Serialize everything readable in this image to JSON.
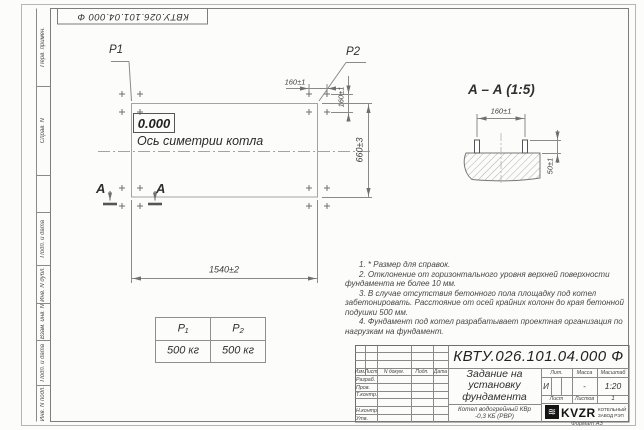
{
  "colors": {
    "paper": "#fcfcfb",
    "line": "#8a8a8a",
    "ink": "#2f2f2f"
  },
  "top_stamp": {
    "code": "КВТУ.026.101.04.000 Ф"
  },
  "margin_fields": {
    "labels": [
      "Перв. примен.",
      "Справ. N",
      "Подп. и дата",
      "Инв. N дубл.",
      "Взам. инв. N",
      "Подп. и дата",
      "Инв. N подл."
    ]
  },
  "plan": {
    "level_mark": "0.000",
    "axis_label": "Ось симетрии котла",
    "p1": "P1",
    "p2": "P2",
    "dim_width": "1540±2",
    "dim_height": "660±3",
    "dim_bolt_x": "160±1",
    "dim_bolt_y": "160±1",
    "section_letter": "А"
  },
  "section": {
    "title": "А – А (1:5)",
    "dim_spacing": "160±1",
    "dim_protrusion": "50±1"
  },
  "loads_table": {
    "headers": [
      "P₁",
      "P₂"
    ],
    "values": [
      "500 кг",
      "500 кг"
    ]
  },
  "notes": [
    "1. * Размер для справок.",
    "2. Отклонение от горизонтального уровня верхней поверхности фундамента не более 10 мм.",
    "3. В случае отсутствия бетонного пола площадку под котел забетонировать. Расстояние от осей крайних колонн до края бетонной подушки 500 мм.",
    "4. Фундамент под котел разрабатывает проектная организация по нагрузкам на фундамент."
  ],
  "title_block": {
    "designation": "КВТУ.026.101.04.000 Ф",
    "doc_title": "Задание на установку фундамента",
    "product": "Котел водогрейный КВр -0,3 КБ (РВР)",
    "rev_headers": [
      "Изм.",
      "Лист",
      "N докум.",
      "Подп.",
      "Дата"
    ],
    "sig_rows": [
      "Разраб.",
      "Пров.",
      "Т.контр.",
      "",
      "Н.контр.",
      "Утв."
    ],
    "lit_label": "Лит.",
    "lit_value": "И",
    "mass_label": "Масса",
    "mass_value": "-",
    "scale_label": "Масштаб",
    "scale_value": "1:20",
    "sheet_label": "Лист",
    "sheets_label": "Листов",
    "sheets_value": "1",
    "company": {
      "abbr": "KVZR",
      "line1": "КОТЕЛЬНЫЙ",
      "line2": "ЗАВОД РЭП"
    },
    "format_note": "Формат А3"
  }
}
